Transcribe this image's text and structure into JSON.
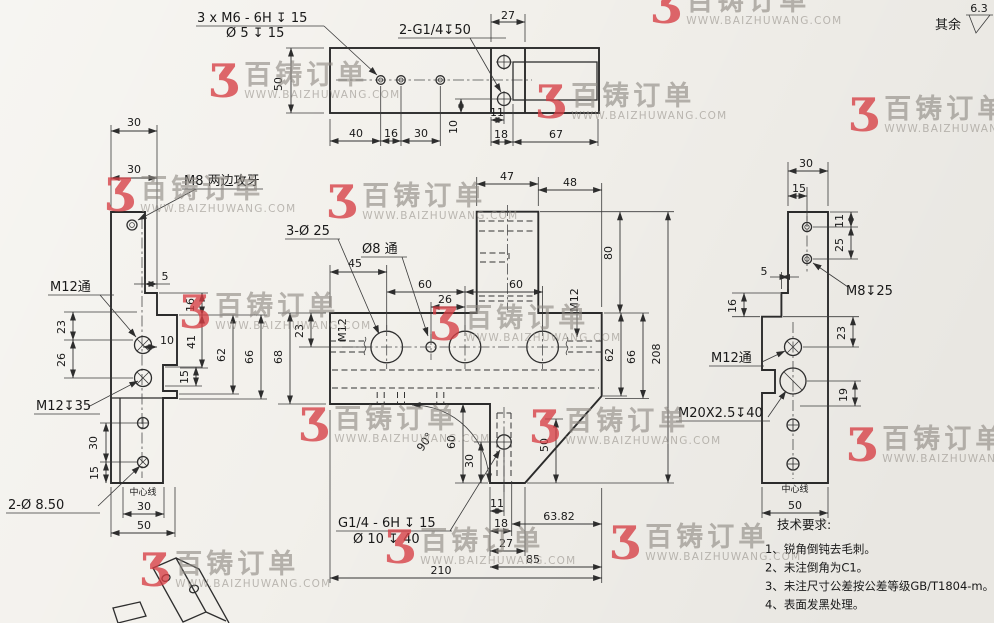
{
  "page": {
    "background": "#f2f0eb",
    "line_color": "#2b2b2b"
  },
  "surface_note": {
    "prefix": "其余",
    "roughness": "6.3"
  },
  "watermark": {
    "glyph": "Ʒ",
    "brand": "百铸订单",
    "url": "WWW.BAIZHUWANG.COM",
    "red": "#d63e44",
    "gray": "#8e8983",
    "positions": [
      [
        210,
        62
      ],
      [
        652,
        -12
      ],
      [
        537,
        83
      ],
      [
        328,
        183
      ],
      [
        106,
        176
      ],
      [
        181,
        293
      ],
      [
        431,
        305
      ],
      [
        300,
        406
      ],
      [
        531,
        408
      ],
      [
        386,
        528
      ],
      [
        611,
        524
      ],
      [
        141,
        551
      ],
      [
        850,
        96
      ],
      [
        848,
        426
      ]
    ]
  },
  "tech_requirements": {
    "title": "技术要求:",
    "items": [
      "1、锐角倒钝去毛刺。",
      "2、未注倒角为C1。",
      "3、未注尺寸公差按公差等级GB/T1804-m。",
      "4、表面发黑处理。"
    ]
  },
  "drawing": {
    "labels": [
      {
        "t": "3 x  M6 - 6H ↧ 15",
        "x": 197,
        "y": 22,
        "a": "s",
        "s": 13
      },
      {
        "t": "Ø 5 ↧ 15",
        "x": 226,
        "y": 37,
        "a": "s",
        "s": 13
      },
      {
        "t": "2-G1/4↧50",
        "x": 399,
        "y": 34,
        "a": "s",
        "s": 13
      },
      {
        "t": "50",
        "x": 282,
        "y": 84,
        "r": -90
      },
      {
        "t": "40",
        "x": 356,
        "y": 137
      },
      {
        "t": "16",
        "x": 391,
        "y": 137
      },
      {
        "t": "30",
        "x": 421,
        "y": 137
      },
      {
        "t": "10",
        "x": 457,
        "y": 127,
        "r": -90
      },
      {
        "t": "11",
        "x": 497,
        "y": 116
      },
      {
        "t": "18",
        "x": 501,
        "y": 138
      },
      {
        "t": "67",
        "x": 556,
        "y": 138
      },
      {
        "t": "27",
        "x": 508,
        "y": 19
      },
      {
        "t": "30",
        "x": 134,
        "y": 126
      },
      {
        "t": "30",
        "x": 134,
        "y": 173
      },
      {
        "t": "M8 两边攻牙",
        "x": 184,
        "y": 185,
        "a": "s",
        "s": 13
      },
      {
        "t": "5",
        "x": 165,
        "y": 280
      },
      {
        "t": "16",
        "x": 194,
        "y": 305,
        "r": -90
      },
      {
        "t": "41",
        "x": 195,
        "y": 342,
        "r": -90
      },
      {
        "t": "62",
        "x": 225,
        "y": 355,
        "r": -90
      },
      {
        "t": "66",
        "x": 253,
        "y": 357,
        "r": -90
      },
      {
        "t": "10",
        "x": 160,
        "y": 344,
        "a": "s"
      },
      {
        "t": "15",
        "x": 188,
        "y": 377,
        "r": -90
      },
      {
        "t": "23",
        "x": 65,
        "y": 327,
        "r": -90
      },
      {
        "t": "26",
        "x": 65,
        "y": 360,
        "r": -90
      },
      {
        "t": "M12通",
        "x": 50,
        "y": 291,
        "a": "s",
        "s": 13
      },
      {
        "t": "M12↧35",
        "x": 36,
        "y": 410,
        "a": "s",
        "s": 13
      },
      {
        "t": "2-Ø 8.50",
        "x": 8,
        "y": 509,
        "a": "s",
        "s": 13
      },
      {
        "t": "30",
        "x": 97,
        "y": 443,
        "r": -90
      },
      {
        "t": "15",
        "x": 98,
        "y": 473,
        "r": -90
      },
      {
        "t": "中心线",
        "x": 143,
        "y": 495,
        "s": 9
      },
      {
        "t": "30",
        "x": 144,
        "y": 510
      },
      {
        "t": "50",
        "x": 144,
        "y": 529
      },
      {
        "t": "3-Ø 25",
        "x": 286,
        "y": 235,
        "a": "s",
        "s": 13
      },
      {
        "t": "Ø8 通",
        "x": 362,
        "y": 253,
        "a": "s",
        "s": 13
      },
      {
        "t": "47",
        "x": 507,
        "y": 180
      },
      {
        "t": "48",
        "x": 570,
        "y": 186
      },
      {
        "t": "80",
        "x": 612,
        "y": 253,
        "r": -90
      },
      {
        "t": "45",
        "x": 355,
        "y": 267
      },
      {
        "t": "60",
        "x": 425,
        "y": 288
      },
      {
        "t": "26",
        "x": 445,
        "y": 303
      },
      {
        "t": "60",
        "x": 516,
        "y": 288
      },
      {
        "t": "M12",
        "x": 346,
        "y": 330,
        "r": -90
      },
      {
        "t": "M12",
        "x": 578,
        "y": 300,
        "r": -90
      },
      {
        "t": "23",
        "x": 303,
        "y": 331,
        "r": -90
      },
      {
        "t": "68",
        "x": 282,
        "y": 357,
        "r": -90
      },
      {
        "t": "62",
        "x": 613,
        "y": 355,
        "r": -90
      },
      {
        "t": "66",
        "x": 635,
        "y": 357,
        "r": -90
      },
      {
        "t": "208",
        "x": 660,
        "y": 354,
        "r": -90
      },
      {
        "t": "90°",
        "x": 428,
        "y": 444,
        "r": -55
      },
      {
        "t": "60",
        "x": 455,
        "y": 442,
        "r": -90
      },
      {
        "t": "30",
        "x": 473,
        "y": 461,
        "r": -90
      },
      {
        "t": "50",
        "x": 548,
        "y": 445,
        "r": -90
      },
      {
        "t": "11",
        "x": 497,
        "y": 507
      },
      {
        "t": "18",
        "x": 501,
        "y": 527
      },
      {
        "t": "27",
        "x": 506,
        "y": 547
      },
      {
        "t": "63.82",
        "x": 559,
        "y": 520
      },
      {
        "t": "85",
        "x": 533,
        "y": 563
      },
      {
        "t": "210",
        "x": 441,
        "y": 574
      },
      {
        "t": "G1/4 - 6H ↧ 15",
        "x": 338,
        "y": 527,
        "a": "s",
        "s": 13
      },
      {
        "t": "Ø 10 ↧ 40",
        "x": 353,
        "y": 543,
        "a": "s",
        "s": 13
      },
      {
        "t": "30",
        "x": 806,
        "y": 167
      },
      {
        "t": "15",
        "x": 799,
        "y": 192
      },
      {
        "t": "11",
        "x": 843,
        "y": 221,
        "r": -90
      },
      {
        "t": "25",
        "x": 843,
        "y": 245,
        "r": -90
      },
      {
        "t": "M8↧25",
        "x": 846,
        "y": 295,
        "a": "s",
        "s": 13
      },
      {
        "t": "5",
        "x": 764,
        "y": 275
      },
      {
        "t": "16",
        "x": 736,
        "y": 306,
        "r": -90
      },
      {
        "t": "M12通",
        "x": 711,
        "y": 362,
        "a": "s",
        "s": 13
      },
      {
        "t": "23",
        "x": 845,
        "y": 333,
        "r": -90
      },
      {
        "t": "19",
        "x": 847,
        "y": 395,
        "r": -90
      },
      {
        "t": "M20X2.5↧40",
        "x": 678,
        "y": 417,
        "a": "s",
        "s": 13
      },
      {
        "t": "中心线",
        "x": 795,
        "y": 492,
        "s": 9
      },
      {
        "t": "50",
        "x": 795,
        "y": 509
      },
      {
        "t": "其余",
        "x": 948,
        "y": 29,
        "s": 13
      },
      {
        "t": "6.3",
        "x": 979,
        "y": 12,
        "s": 11
      }
    ]
  }
}
